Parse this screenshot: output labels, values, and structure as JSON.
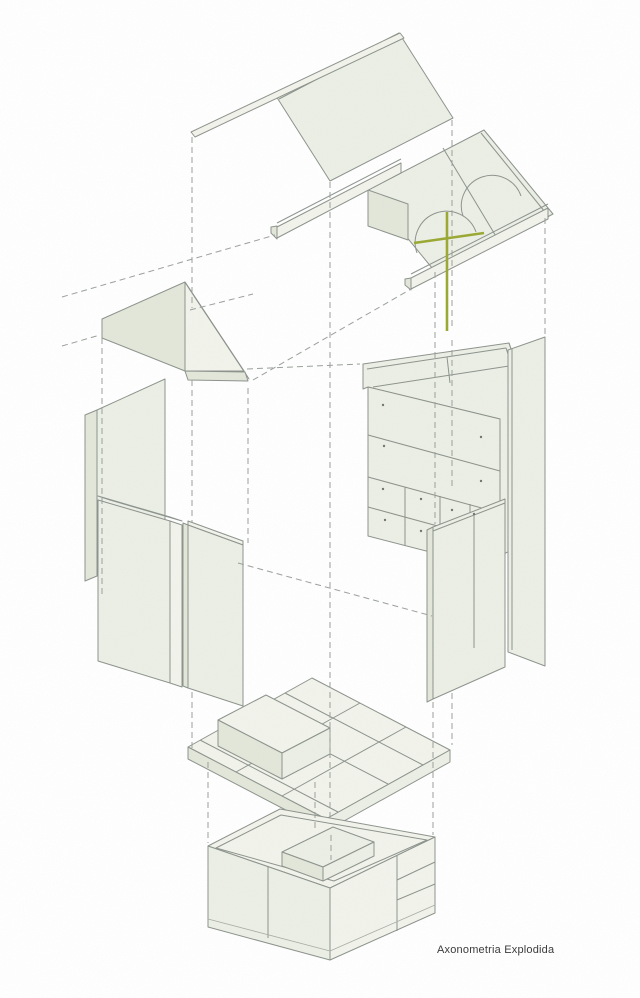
{
  "caption": {
    "text": "Axonometria Explodida"
  },
  "diagram": {
    "type": "exploded-axonometric-architecture",
    "parts": [
      "roof-panel",
      "ridge-beam",
      "upper-floor-slab",
      "arched-opening-left",
      "arched-opening-right",
      "eave-beam-left",
      "eave-beam-front",
      "cross-marker",
      "gable-wall",
      "wall-panel-back-left",
      "wall-panel-left-1",
      "wall-panel-left-2",
      "shelving-unit",
      "wall-panel-right-back",
      "wall-panel-right-front",
      "mid-floor-plate",
      "box-volume",
      "base-module"
    ]
  },
  "colors": {
    "background": "#ffffff",
    "face": "#ecefe5",
    "face_light": "#f2f4ec",
    "face_dark": "#e3e7da",
    "line": "#8c938c",
    "dashed_line": "#9aa09a",
    "accent_green": "#9aa832",
    "text": "#3c3c3c"
  }
}
